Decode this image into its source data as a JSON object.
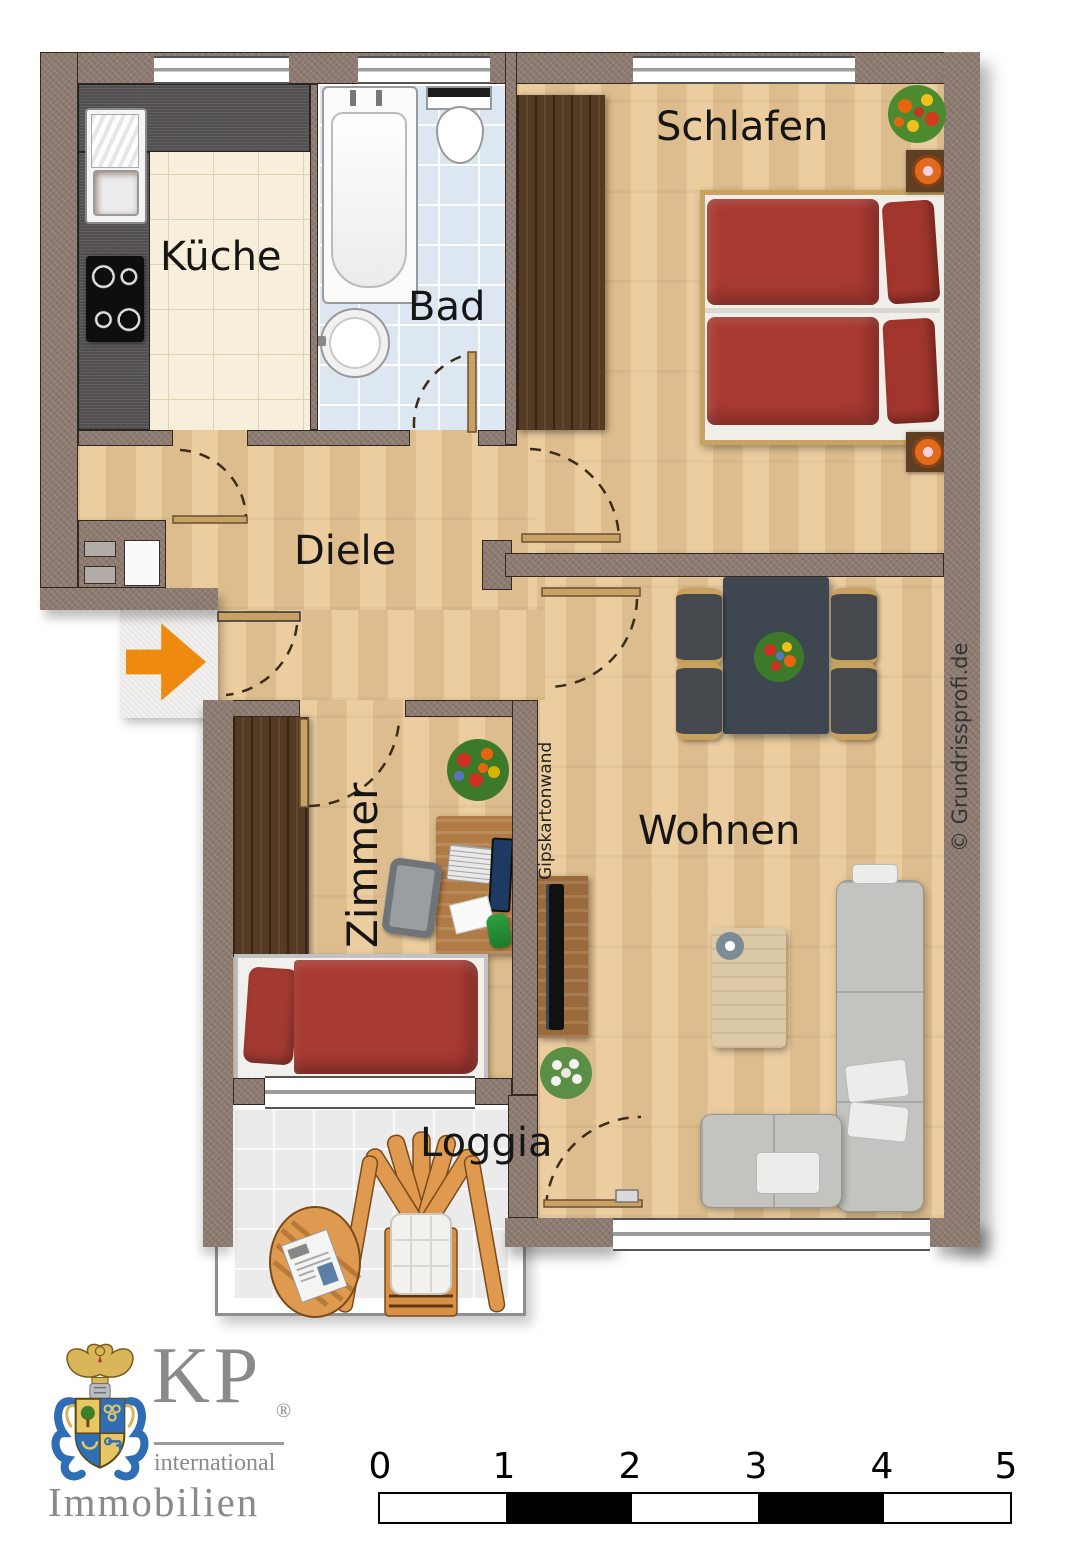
{
  "document": {
    "type": "apartment-floor-plan",
    "background": "#ffffff"
  },
  "rooms": {
    "kueche": {
      "label": "Küche"
    },
    "bad": {
      "label": "Bad"
    },
    "schlafen": {
      "label": "Schlafen"
    },
    "diele": {
      "label": "Diele"
    },
    "zimmer": {
      "label": "Zimmer"
    },
    "wohnen": {
      "label": "Wohnen"
    },
    "loggia": {
      "label": "Loggia"
    }
  },
  "annotations": {
    "partition_label": "Gipskartonwand",
    "copyright": "© Grundrissprofi.de"
  },
  "entrance": {
    "icon": "entrance-arrow",
    "color": "#ef8a10"
  },
  "scale_bar": {
    "unit_labels": [
      "0",
      "1",
      "2",
      "3",
      "4",
      "5"
    ],
    "segments": [
      "#ffffff",
      "#000000",
      "#ffffff",
      "#000000",
      "#ffffff"
    ]
  },
  "logo": {
    "monogram": "KP",
    "registered_mark": "®",
    "subtitle": "international",
    "title": "Immobilien"
  },
  "palette": {
    "wall": "#8d7b71",
    "wood_floor": "#e9c795",
    "kitchen_tile": "#f7efdb",
    "bath_tile": "#dde7f1",
    "loggia_tile": "#ebebeb",
    "bed_textile": "#a83a31",
    "dining_table": "#3e4650",
    "sofa": "#c2c2be",
    "counter": "#4e4c4a",
    "wardrobe": "#553b24"
  }
}
